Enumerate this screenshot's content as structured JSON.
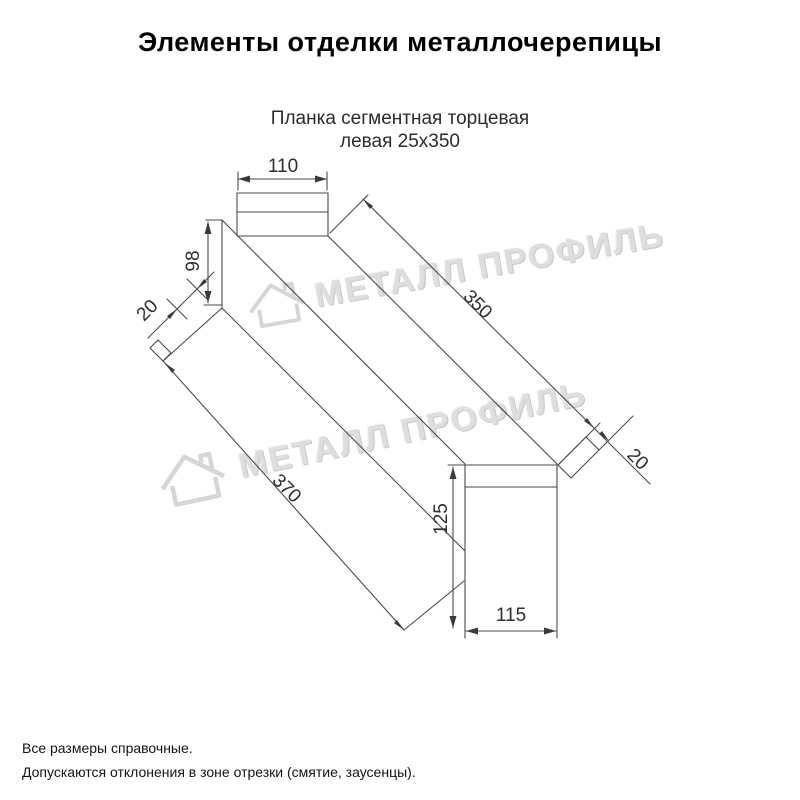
{
  "header": {
    "title": "Элементы отделки металлочерепицы"
  },
  "drawing": {
    "part_name_line1": "Планка сегментная торцевая",
    "part_name_line2": "левая 25х350",
    "dimensions": {
      "top_width": "110",
      "side_height": "98",
      "left_hem": "20",
      "top_length": "350",
      "bottom_length": "370",
      "end_height": "125",
      "end_width": "115",
      "end_hem": "20"
    }
  },
  "watermark": {
    "text": "МЕТАЛЛ ПРОФИЛЬ",
    "logo": "house-icon",
    "color": "#dedede"
  },
  "footer": {
    "line1": "Все размеры справочные.",
    "line2": "Допускаются отклонения в зоне отрезки (смятие, заусенцы)."
  },
  "colors": {
    "line": "#4a4a4a",
    "dim_text": "#2e2e2e",
    "background": "#ffffff"
  }
}
